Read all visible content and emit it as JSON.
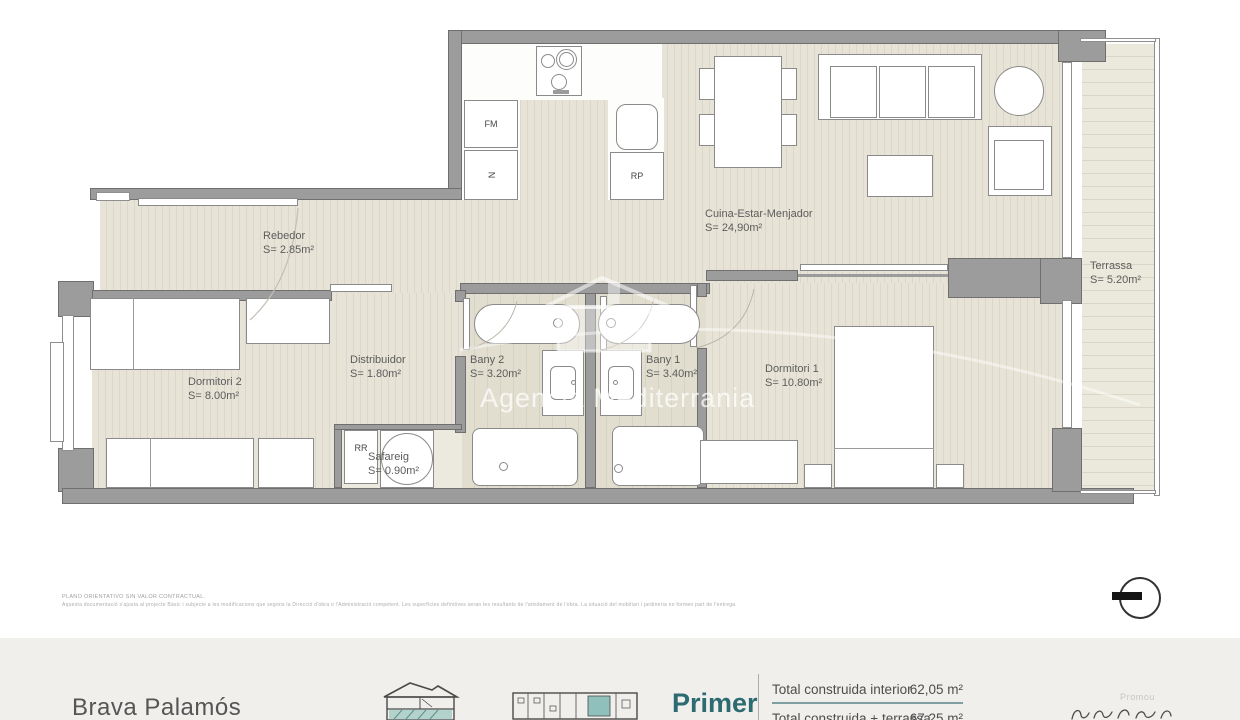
{
  "watermark": {
    "text": "Agencia Mediterrania"
  },
  "rooms": {
    "rebedor": {
      "name": "Rebedor",
      "area": "S= 2.85m²"
    },
    "cuina": {
      "name": "Cuina-Estar-Menjador",
      "area": "S= 24,90m²"
    },
    "terrassa": {
      "name": "Terrassa",
      "area": "S= 5.20m²"
    },
    "dormitori2": {
      "name": "Dormitori 2",
      "area": "S= 8.00m²"
    },
    "distribuidor": {
      "name": "Distribuidor",
      "area": "S= 1.80m²"
    },
    "bany2": {
      "name": "Bany 2",
      "area": "S= 3.20m²"
    },
    "bany1": {
      "name": "Bany 1",
      "area": "S= 3.40m²"
    },
    "dormitori1": {
      "name": "Dormitori 1",
      "area": "S= 10.80m²"
    },
    "safareig": {
      "name": "Safareig",
      "area": "S= 0.90m²"
    }
  },
  "appliances": {
    "fm": "FM",
    "nevera": "N",
    "rp": "RP",
    "rr": "RR"
  },
  "disclaimer": {
    "line1": "PLANO ORIENTATIVO SIN VALOR CONTRACTUAL.",
    "line2": "Aquesta documentació s'ajusta al projecte Bàsic i subjecte a les modificacions que segons la Direcció d'obra o l'Administració competent. Les superfícies definitives seran les resultants de l'amidament de l'obra. La situació del mobiliari i jardineria no formen part de l'entrega."
  },
  "footer": {
    "project_name": "Brava Palamós",
    "floor_label": "Primer",
    "promoter_label": "Promou",
    "areas": {
      "row1_label": "Total construida interior",
      "row1_value": "62,05 m²",
      "row2_label": "Total construida + terrassa",
      "row2_value": "67,25 m²"
    }
  },
  "colors": {
    "accent_teal": "#2c6b70",
    "wall_gray": "#9c9c9c",
    "underline_teal": "#7f9fa3"
  }
}
